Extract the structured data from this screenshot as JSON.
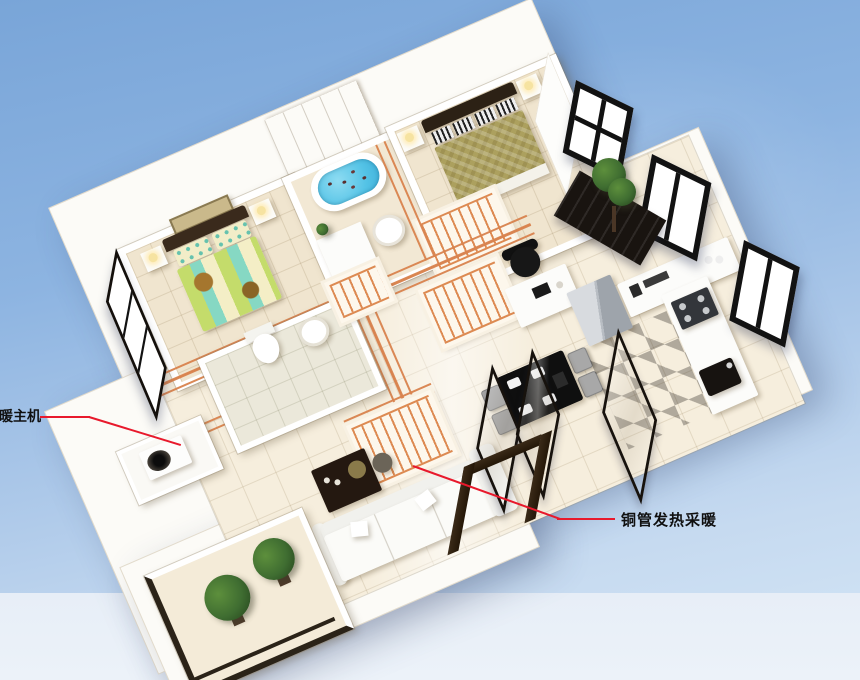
{
  "meta": {
    "description": "3D isometric cutaway render of an apartment floor plan demonstrating a copper-pipe floor heating system",
    "width_px": 860,
    "height_px": 680
  },
  "background": {
    "sky_top": "#79a5d8",
    "sky_mid": "#a9c6e8",
    "sky_bottom": "#cde0f3",
    "ground_band": "#e9f0f8"
  },
  "annotations": {
    "heat_pump": {
      "label": "暖主机",
      "text_color": "#101010",
      "line_color": "#e8192c"
    },
    "floor_heating": {
      "label": "铜管发热采暖",
      "text_color": "#101010",
      "line_color": "#e8192c"
    }
  },
  "palette": {
    "wall": "#ffffff",
    "bedroom_floor": "#f0e5cf",
    "hall_floor": "#f6eedd",
    "toilet_floor": "#ebe8da",
    "copper_pipe": "#d9834e",
    "heating_coil": "#dd8a52",
    "tub_water": "#5ec9e9",
    "bath_tile_wall": "#c4a570",
    "window_frame": "#121212",
    "door_wood": "#2e2013",
    "bed2_quilt_green": "#b8d96a",
    "bed2_quilt_teal": "#7fd6c2",
    "master_quilt_olive": "#aca05e",
    "sofa_white": "#fafaf8",
    "dining_table_black": "#0f0f0f",
    "chair_gray": "#a8a8a8",
    "plant_green": "#3f6d31"
  },
  "rooms": [
    "bedroom-2",
    "bathroom",
    "master-bedroom",
    "hallway",
    "toilet-room",
    "study-area",
    "living-room",
    "dining-area",
    "kitchen",
    "balcony",
    "heat-pump-ledge"
  ]
}
